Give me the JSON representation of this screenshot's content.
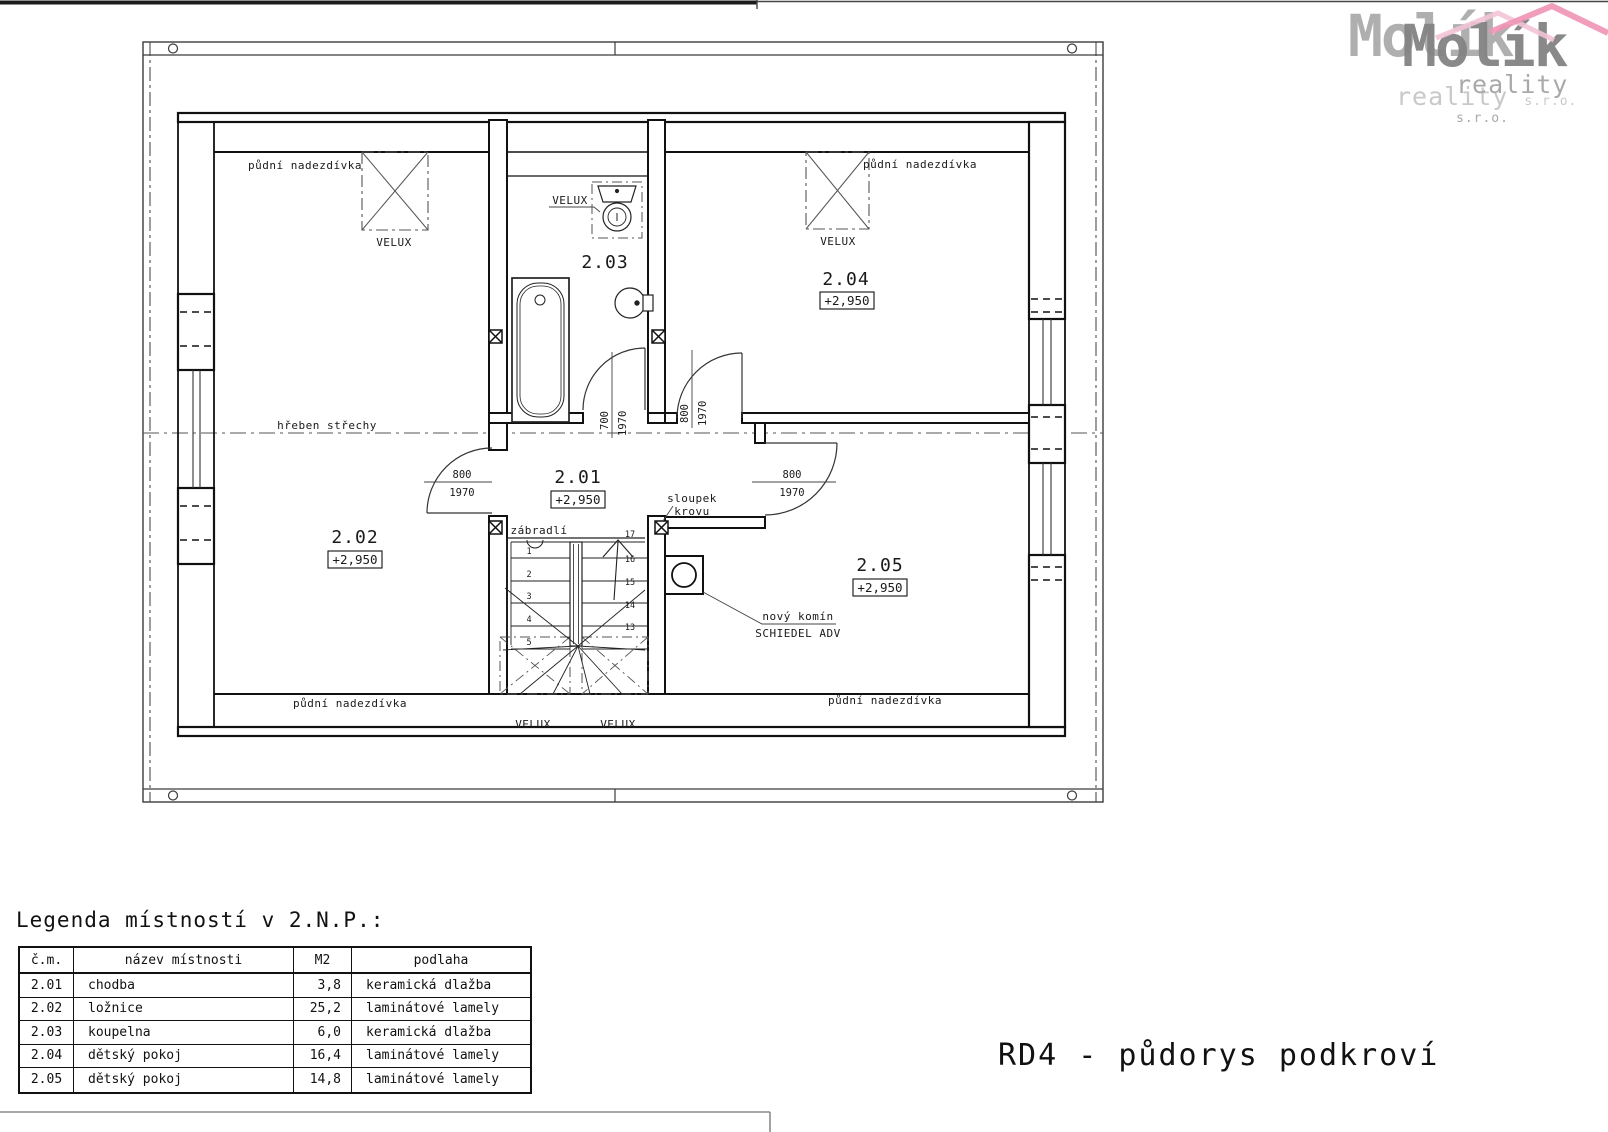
{
  "logo": {
    "name": "Molík",
    "line2": "reality",
    "suffix": "s.r.o."
  },
  "plan": {
    "rooms": {
      "r201": {
        "id": "2.01",
        "level": "+2,950"
      },
      "r202": {
        "id": "2.02",
        "level": "+2,950"
      },
      "r203": {
        "id": "2.03"
      },
      "r204": {
        "id": "2.04",
        "level": "+2,950"
      },
      "r205": {
        "id": "2.05",
        "level": "+2,950"
      }
    },
    "labels": {
      "knee_wall": "půdní nadezdívka",
      "ridge": "hřeben střechy",
      "skylight": "VELUX",
      "railing": "zábradlí",
      "truss_post_line1": "sloupek",
      "truss_post_line2": "krovu",
      "chimney_line1": "nový komín",
      "chimney_line2": "SCHIEDEL ADV"
    },
    "dims": {
      "w800": "800",
      "w700": "700",
      "h1970": "1970"
    },
    "stairs": {
      "left": [
        "1",
        "2",
        "3",
        "4",
        "5"
      ],
      "right": [
        "17",
        "16",
        "15",
        "14",
        "13"
      ]
    }
  },
  "legend": {
    "title": "Legenda místností v 2.N.P.:",
    "headers": [
      "č.m.",
      "název místnosti",
      "M2",
      "podlaha"
    ],
    "rows": [
      [
        "2.01",
        "chodba",
        "3,8",
        "keramická dlažba"
      ],
      [
        "2.02",
        "ložnice",
        "25,2",
        "laminátové lamely"
      ],
      [
        "2.03",
        "koupelna",
        "6,0",
        "keramická dlažba"
      ],
      [
        "2.04",
        "dětský pokoj",
        "16,4",
        "laminátové lamely"
      ],
      [
        "2.05",
        "dětský pokoj",
        "14,8",
        "laminátové lamely"
      ]
    ]
  },
  "title": "RD4 - půdorys podkroví"
}
